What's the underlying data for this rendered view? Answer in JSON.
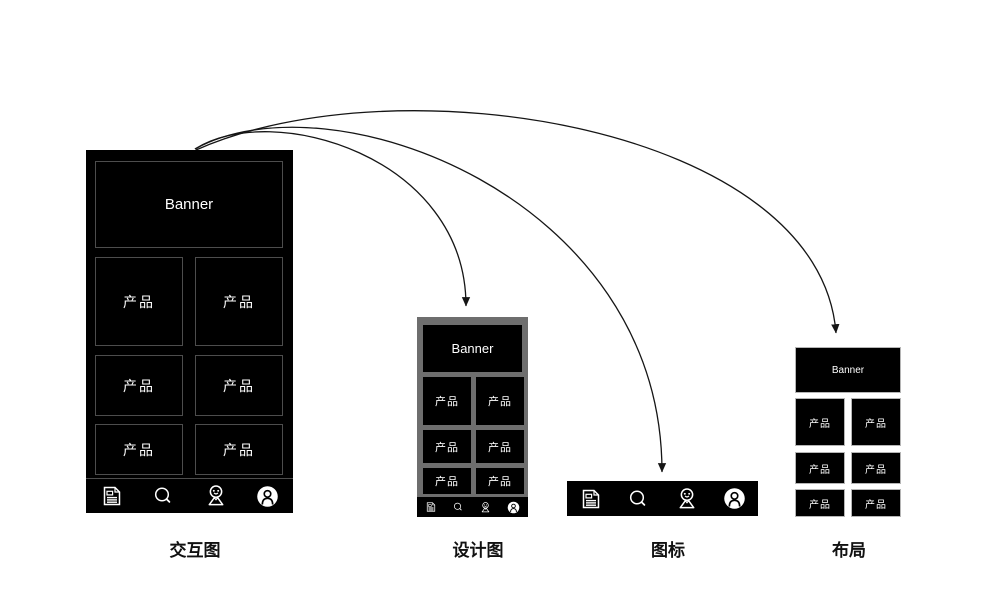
{
  "interaction_mockup": {
    "banner_label": "Banner",
    "product_label": "产品",
    "caption": "交互图"
  },
  "design_mockup": {
    "banner_label": "Banner",
    "product_label": "产品",
    "caption": "设计图"
  },
  "icons_bar": {
    "caption": "图标",
    "tabbar_icons": [
      "news-icon",
      "search-icon",
      "location-pin-icon",
      "profile-icon"
    ]
  },
  "layout_mockup": {
    "banner_label": "Banner",
    "product_label": "产品",
    "caption": "布局"
  },
  "colors": {
    "mockup_black": "#000000",
    "design_frame_gray": "#6e6e6e",
    "cell_border_dark": "#4d4d4d",
    "cell_border_light": "#b5b5b5",
    "arrow": "#151515",
    "text_on_dark": "#ffffff"
  }
}
